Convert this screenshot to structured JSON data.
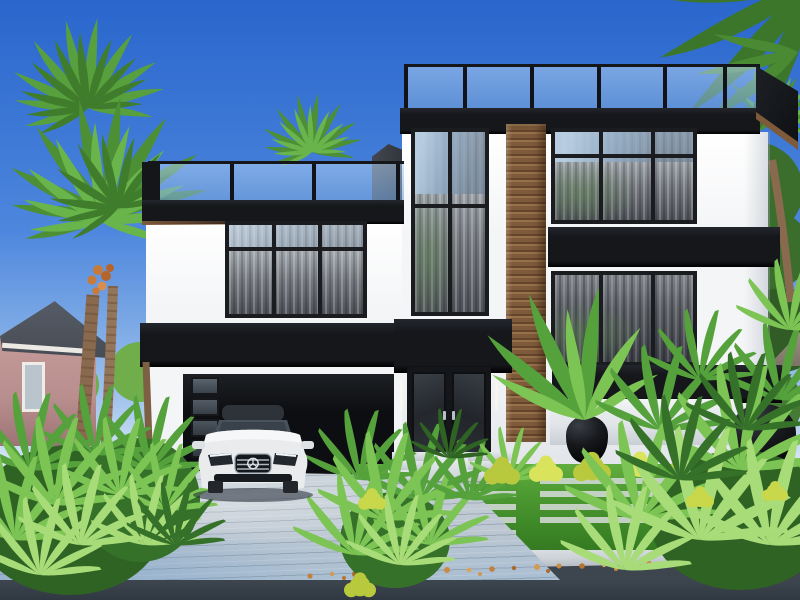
{
  "scene": {
    "type": "3d-architectural-exterior-rendering",
    "time_of_day": "day, clear blue sky",
    "objects": [
      "modern two-story black and white house",
      "rooftop glass railings with black posts",
      "black fascia and accent bands",
      "vertical wood slat accent column",
      "floor-to-ceiling windows with sheer curtains",
      "black garage door with side glass strip",
      "white luxury sedan parked on driveway",
      "black double entry doors with glass",
      "concrete entry steps",
      "black round planter pots",
      "white planter wall",
      "tropical plants and palm trees",
      "striped paver and grass front lawn",
      "paver plank driveway",
      "sidewalk with fallen orange leaves",
      "asphalt road",
      "pink neighbor house on left",
      "neighbor roof gable on right"
    ]
  },
  "palette": {
    "sky_top": "#2a66cc",
    "sky_mid": "#4c86dd",
    "sky_low": "#9fc2ec",
    "sky_horizon": "#dce9f6",
    "blk": "#15171b",
    "wd": "#7e5a3a",
    "wdd": "#64452a",
    "wdl": "#96714c",
    "wall": "#f4f5f7",
    "walls": "#e1e4e9",
    "wf": "#1a1c20",
    "gar": "#0d0e11",
    "dw": "#c6cfd7",
    "dwb": "#a9bed2",
    "sw": "#ccd2d7",
    "rd": "#3d454f",
    "rdd": "#2f3740",
    "lawn": "#4f9c33",
    "lawnd": "#3c8527",
    "pav": "#ccd6ce",
    "leaf_orange": "#c98a45",
    "plant_dark": "#36712a",
    "plant_mid": "#55a23c",
    "plant_bright": "#7cc454",
    "plant_light": "#a8dc79",
    "bush_yellow": "#b9c93e",
    "bush_yellow_light": "#d9e45c",
    "trunk": "#8a6a4e",
    "trunk_dark": "#6b4f36",
    "neighbor_wall": "#b98e8e",
    "neighbor_roof": "#474c54",
    "pot": "#17191d",
    "car_body": "#e9ebed"
  }
}
